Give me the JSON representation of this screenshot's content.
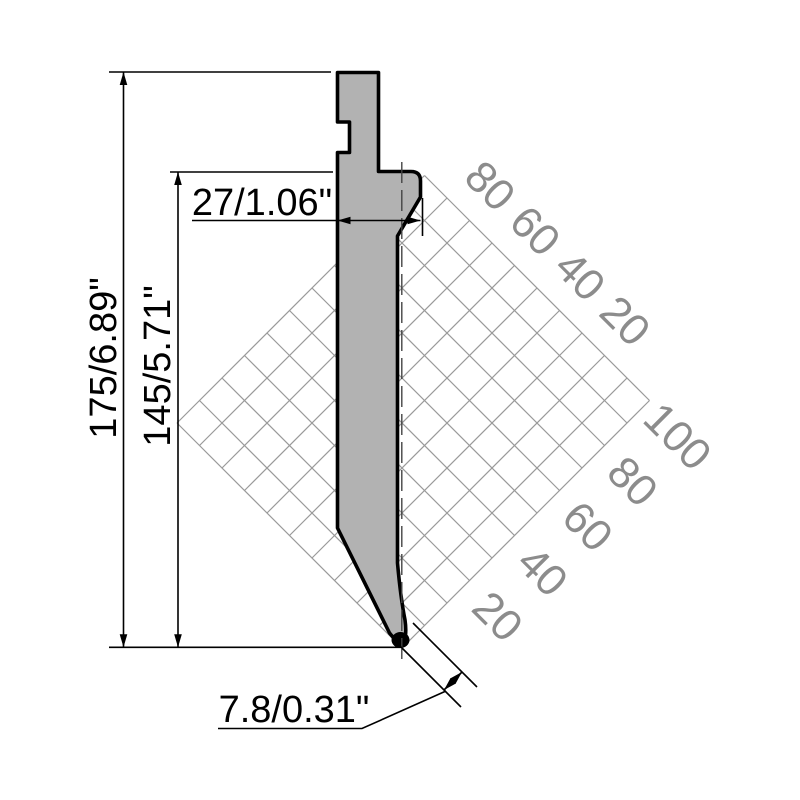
{
  "title": "Press brake punch technical drawing",
  "dimensions": {
    "total_height": {
      "label": "175/6.89\""
    },
    "working_height": {
      "label": "145/5.71\""
    },
    "shoulder_width": {
      "label": "27/1.06\""
    },
    "tip_width": {
      "label": "7.8/0.31\""
    }
  },
  "grid": {
    "upper_axis_labels": [
      "80",
      "60",
      "40",
      "20"
    ],
    "lower_axis_labels": [
      "100",
      "80",
      "60",
      "40",
      "20"
    ],
    "unit_step": 10,
    "label_step": 20,
    "line_color": "#9a9a9a",
    "label_color": "#8c8c8c"
  },
  "part": {
    "fill_color": "#b2b2b2",
    "outline_color": "#000000"
  }
}
